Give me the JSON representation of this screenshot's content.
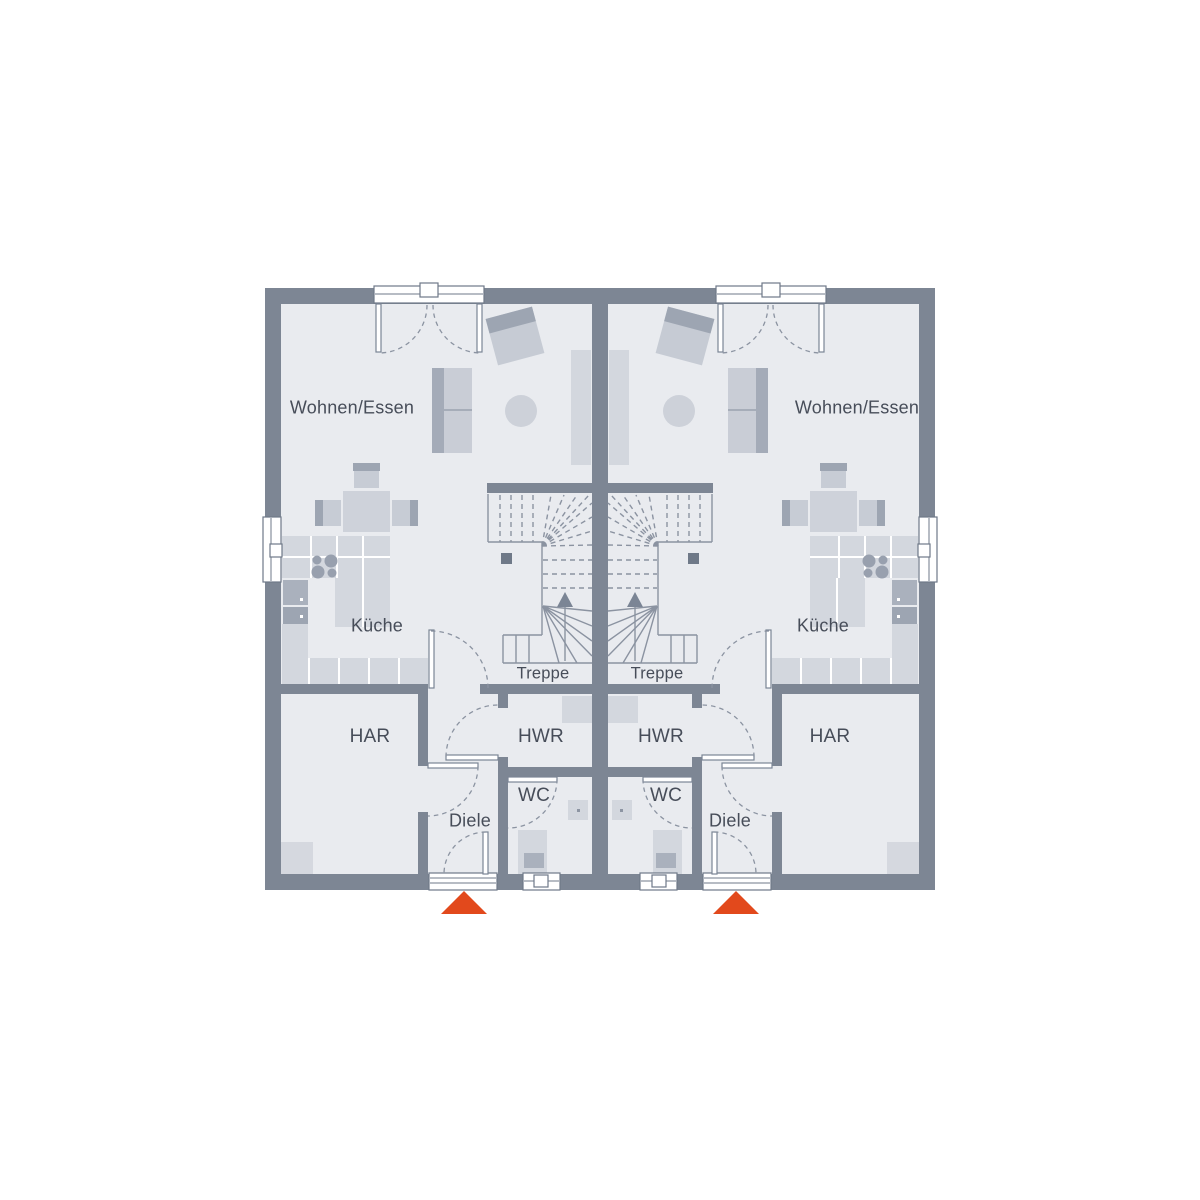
{
  "rooms": {
    "living_dining": "Wohnen/Essen",
    "kitchen": "Küche",
    "har": "HAR",
    "hwr": "HWR",
    "wc": "WC",
    "hall": "Diele",
    "stairs": "Treppe"
  },
  "markers": {
    "entrance_left": "entrance-triangle-up",
    "entrance_right": "entrance-triangle-up"
  },
  "colors": {
    "background": "#ffffff",
    "wall": "#7d8694",
    "floor": "#e9ebef",
    "furniture": "#d3d7de",
    "furniture_mid": "#c7ccd5",
    "furniture_dark": "#9da5b2",
    "appliance": "#aab1bd",
    "line": "#8b93a1",
    "label": "#474d59",
    "accent_entrance": "#e2491c"
  }
}
